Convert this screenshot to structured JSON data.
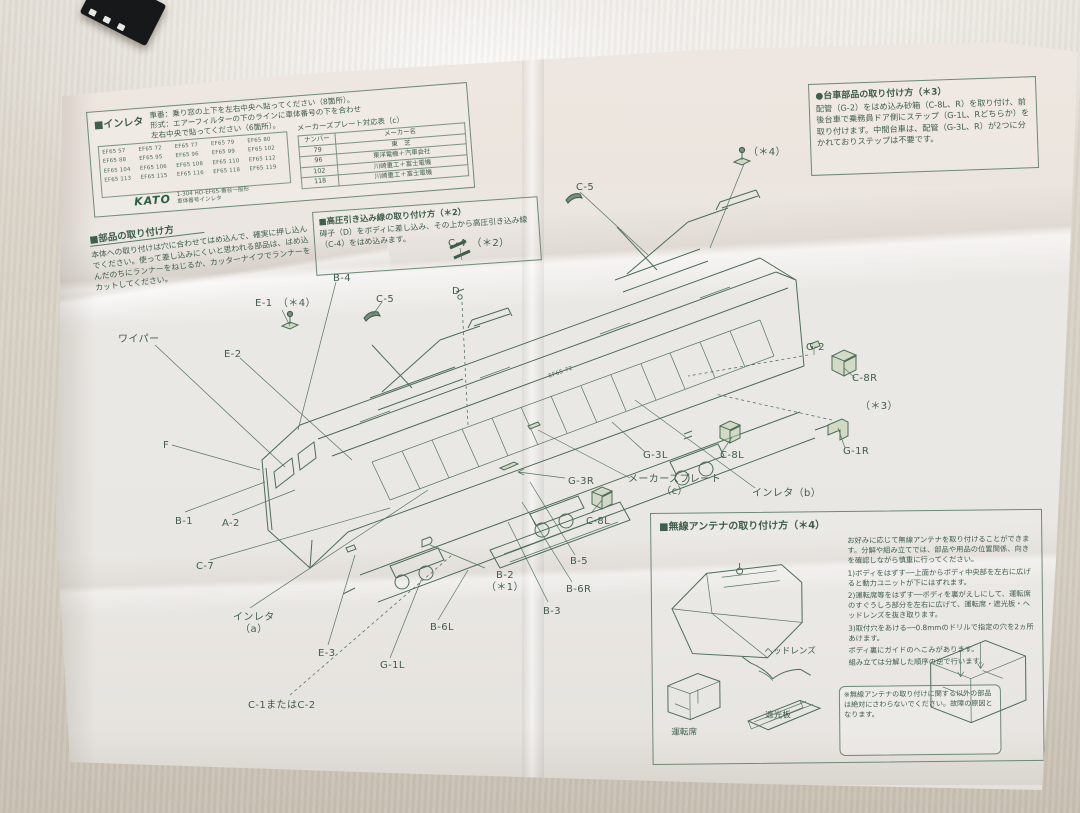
{
  "scene": {
    "prop": "black-model-box"
  },
  "paper": {
    "inleta_box": {
      "title": "■インレタ",
      "desc_line1": "車番：乗り窓の上下を左右中央へ貼ってください（8箇所）。",
      "desc_line2": "形式：エアーフィルターの下のラインに車体番号の下を合わせ",
      "desc_line3": "左右中央で貼ってください（6箇所）。",
      "numbers": [
        [
          "EF65 57",
          "EF65 72",
          "EF65 77",
          "EF65 79",
          "EF65 80"
        ],
        [
          "EF65 88",
          "EF65 95",
          "EF65 96",
          "EF65 99",
          "EF65 102"
        ],
        [
          "EF65 104",
          "EF65 106",
          "EF65 108",
          "EF65 110",
          "EF65 112"
        ],
        [
          "EF65 113",
          "EF65 115",
          "EF65 116",
          "EF65 118",
          "EF65 119"
        ]
      ],
      "kato_logo": "KATO",
      "kato_note_line1": "1-304 HO-EF65-番台一般形",
      "kato_note_line2": "車体番号インレタ",
      "plate_table": {
        "title": "メーカーズプレート対応表（c）",
        "headers": [
          "ナンバー",
          "メーカー名"
        ],
        "rows": [
          [
            "79",
            "東　芝"
          ],
          [
            "96",
            "東洋電機＋汽車会社"
          ],
          [
            "102",
            "川崎重工＋富士電機"
          ],
          [
            "118",
            "川崎重工＋富士電機"
          ]
        ]
      }
    },
    "parts_box": {
      "title": "■部品の取り付け方",
      "body": "本体への取り付けは穴に合わせてはめ込んで、確実に押し込んでください。使って差し込みにくいと思われる部品は、はめ込んだのちにランナーをねじるか、カッターナイフでランナーをカットしてください。"
    },
    "highvoltage_box": {
      "title": "■高圧引き込み線の取り付け方（＊2）",
      "body": "碍子（D）をボディに差し込み、その上から高圧引き込み線（C-4）をはめ込みます。"
    },
    "bogie_box": {
      "title": "●台車部品の取り付け方（＊3）",
      "body": "配管（G-2）をはめ込み砂箱（C-8L、R）を取り付け、前後台車で乗務員ドア側にステップ（G-1L、Rどちらか）を取り付けます。中間台車は、配管（G-3L、R）が2つに分かれておりステップは不要です。"
    },
    "antenna_box": {
      "title": "■無線アンテナの取り付け方（＊4）",
      "intro": "お好みに応じて無線アンテナを取り付けることができます。分解や組み立てでは、部品や用品の位置関係、向きを確認しながら慎重に行ってください。",
      "steps": [
        "1)ボディをはずす──上面からボディ中央部を左右に広げると動力ユニットが下にはずれます。",
        "2)運転席等をはずす──ボディを裏がえしにして、運転席のすぐうしろ部分を左右に広げて、運転席・遮光板・ヘッドレンズを抜き取ります。",
        "3)取付穴をあける──0.8mmのドリルで指定の穴を2ヵ所あけます。",
        "ボディ裏にガイドのへこみがあります。",
        "組み立ては分解した順序の逆で行います。"
      ],
      "note": "※無線アンテナの取り付けに関する以外の部品は絶対にさわらないでください。故障の原因となります。",
      "sketch_labels": {
        "headlens": "ヘッドレンズ",
        "seat": "運転席",
        "shade": "遮光板"
      }
    },
    "diagram": {
      "body_number": "EF65 72",
      "labels": [
        {
          "t": "ワイパー",
          "x": 118,
          "y": 334
        },
        {
          "t": "E-2",
          "x": 224,
          "y": 349
        },
        {
          "t": "E-1　（＊4）",
          "x": 255,
          "y": 298
        },
        {
          "t": "B-4",
          "x": 333,
          "y": 273
        },
        {
          "t": "C-5",
          "x": 376,
          "y": 294
        },
        {
          "t": "C-4　（＊2）",
          "x": 448,
          "y": 238
        },
        {
          "t": "D",
          "x": 452,
          "y": 286
        },
        {
          "t": "C-5",
          "x": 576,
          "y": 182
        },
        {
          "t": "（＊4）",
          "x": 748,
          "y": 147
        },
        {
          "t": "F",
          "x": 163,
          "y": 440
        },
        {
          "t": "B-1",
          "x": 175,
          "y": 516
        },
        {
          "t": "A-2",
          "x": 222,
          "y": 518
        },
        {
          "t": "C-7",
          "x": 196,
          "y": 561
        },
        {
          "t": "インレタ\n（a）",
          "x": 233,
          "y": 612
        },
        {
          "t": "E-3",
          "x": 318,
          "y": 648
        },
        {
          "t": "C-1またはC-2",
          "x": 248,
          "y": 700
        },
        {
          "t": "G-1L",
          "x": 380,
          "y": 660
        },
        {
          "t": "B-6L",
          "x": 430,
          "y": 622
        },
        {
          "t": "B-2\n（＊1）",
          "x": 486,
          "y": 570
        },
        {
          "t": "B-3",
          "x": 543,
          "y": 606
        },
        {
          "t": "B-6R",
          "x": 566,
          "y": 584
        },
        {
          "t": "B-5",
          "x": 570,
          "y": 556
        },
        {
          "t": "C-8L",
          "x": 586,
          "y": 516
        },
        {
          "t": "G-3R",
          "x": 568,
          "y": 476
        },
        {
          "t": "メーカーズプレート\n（c）",
          "x": 628,
          "y": 474
        },
        {
          "t": "G-3L",
          "x": 643,
          "y": 450
        },
        {
          "t": "C-8L",
          "x": 720,
          "y": 450
        },
        {
          "t": "インレタ（b）",
          "x": 752,
          "y": 488
        },
        {
          "t": "G-2",
          "x": 806,
          "y": 342
        },
        {
          "t": "C-8R",
          "x": 852,
          "y": 373
        },
        {
          "t": "（＊3）",
          "x": 860,
          "y": 401
        },
        {
          "t": "G-1R",
          "x": 843,
          "y": 446
        },
        {
          "t": "EF65 72",
          "x": 548,
          "y": 374,
          "r": -20,
          "s": 5.5
        }
      ]
    }
  }
}
